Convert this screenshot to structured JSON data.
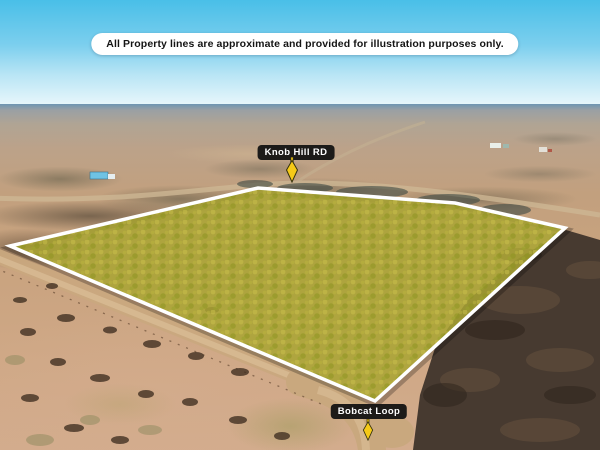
{
  "disclaimer": {
    "text": "All Property lines are approximate and provided for illustration purposes only."
  },
  "road_labels": {
    "knob_hill": "Knob Hill RD",
    "bobcat_loop": "Bobcat Loop"
  },
  "property": {
    "boundary_points": "10,246 258,188 455,203 565,228 375,401",
    "fill_color": "#a9a532",
    "stroke_color": "#ffffff",
    "marker_color": "#f5c918",
    "marker_outline_color": "#33300e"
  },
  "colors": {
    "sky_top": "#49bfe8",
    "label_background": "#121212",
    "banner_background": "#ffffff",
    "burnt_terrain": "#473a30",
    "dirt_road": "#c9a87e"
  }
}
